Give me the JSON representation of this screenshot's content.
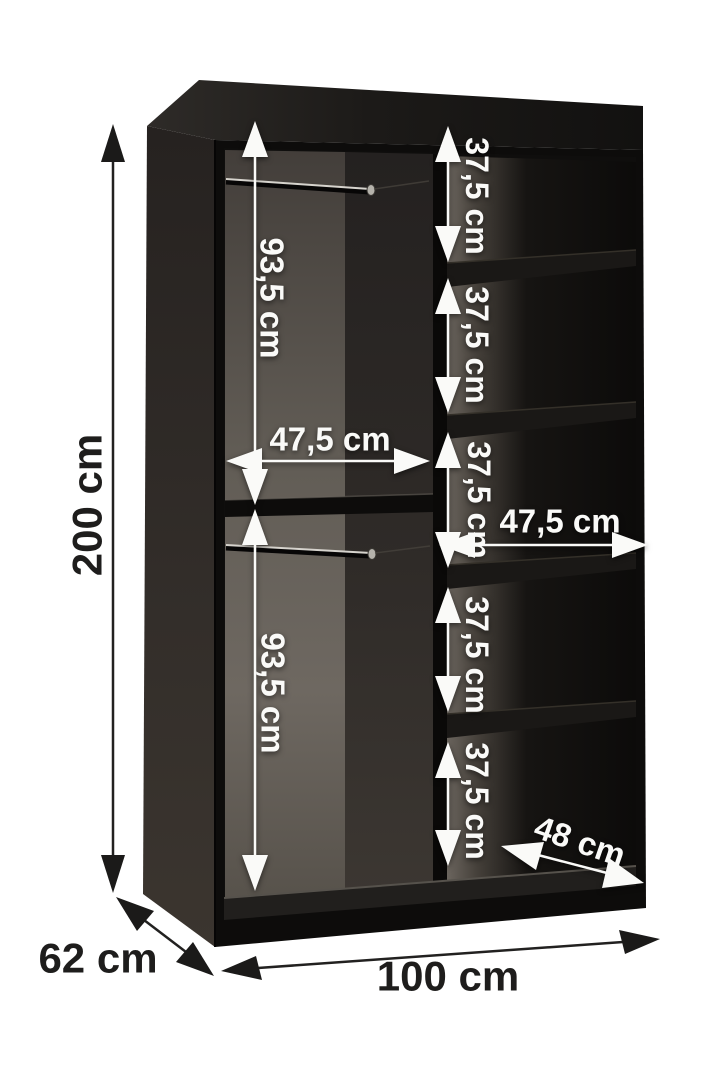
{
  "diagram": {
    "kind": "wardrobe-interior-dimensions",
    "unit": "cm",
    "outer": {
      "height_label": "200 cm",
      "depth_label": "62 cm",
      "width_label": "100 cm"
    },
    "interior": {
      "left_upper_height_label": "93,5 cm",
      "left_lower_height_label": "93,5 cm",
      "left_width_label": "47,5 cm",
      "right_width_label": "47,5 cm",
      "shelf_gap_labels": [
        "37,5 cm",
        "37,5 cm",
        "37,5 cm",
        "37,5 cm",
        "37,5 cm"
      ],
      "shelf_depth_label": "48 cm"
    },
    "colors": {
      "background": "#ffffff",
      "cabinet_body": "#0d0c0b",
      "interior_panel_gray": "#6b655e",
      "dimension_dark": "#1e1d1c",
      "dimension_light": "#fafaf8"
    }
  }
}
